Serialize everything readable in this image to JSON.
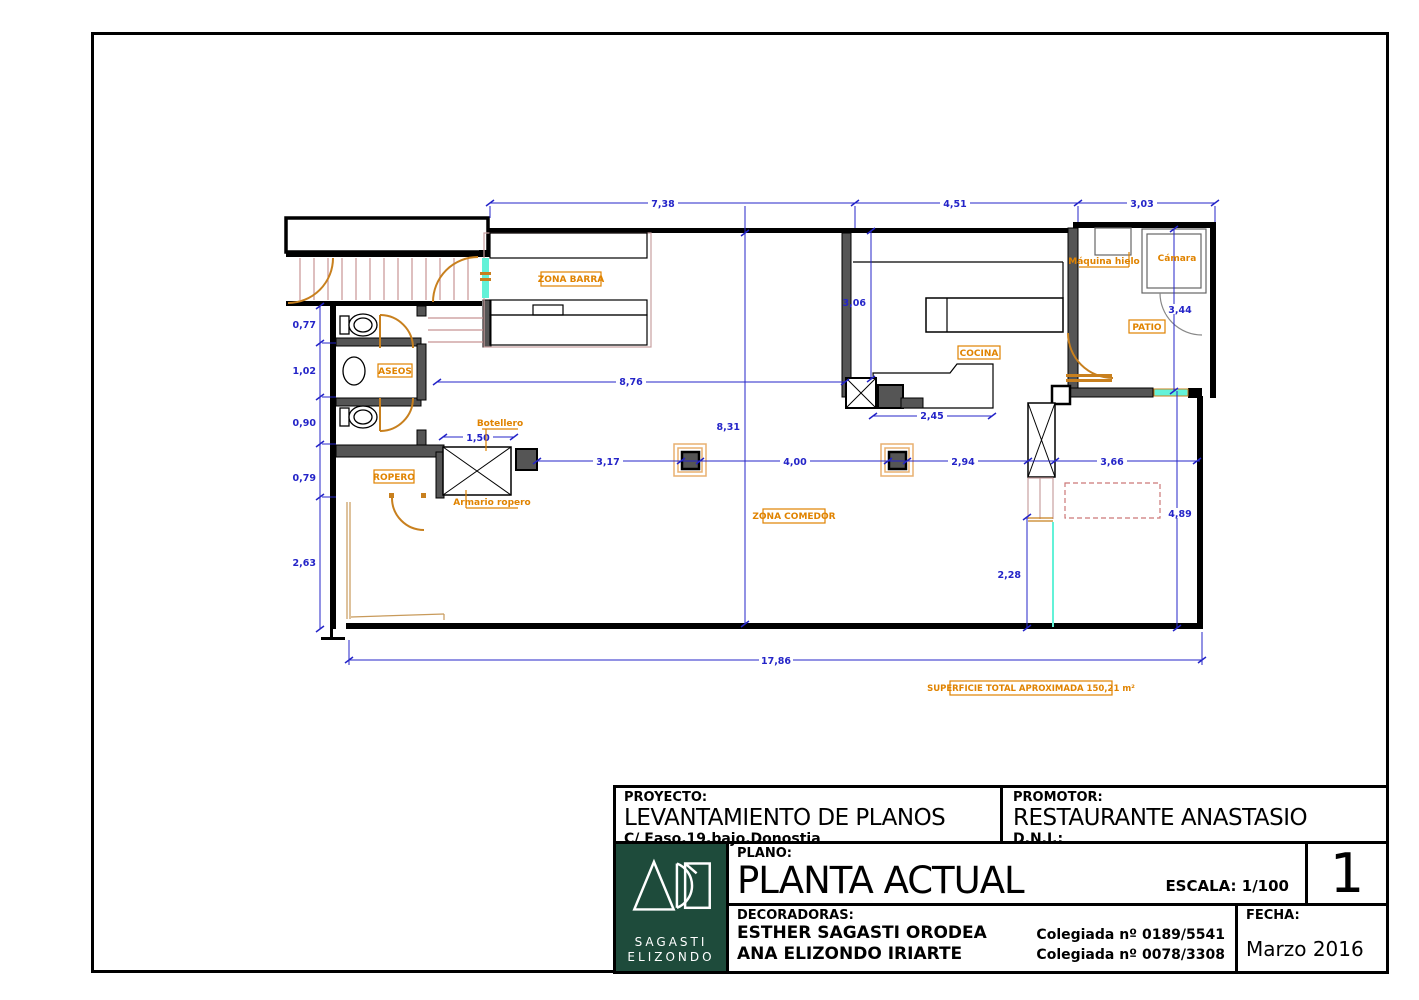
{
  "title_block": {
    "proyecto_label": "PROYECTO:",
    "proyecto_title": "LEVANTAMIENTO DE PLANOS",
    "proyecto_address": "C/ Easo,19,bajo.Donostia",
    "promotor_label": "PROMOTOR:",
    "promotor_name": "RESTAURANTE ANASTASIO",
    "dni_label": "D.N.I.:",
    "plano_label": "PLANO:",
    "plano_title": "PLANTA ACTUAL",
    "escala": "ESCALA: 1/100",
    "sheet_number": "1",
    "decoradoras_label": "DECORADORAS:",
    "decoradora_1": "ESTHER SAGASTI ORODEA",
    "decoradora_2": "ANA ELIZONDO IRIARTE",
    "colegiada_1": "Colegiada  nº 0189/5541",
    "colegiada_2": "Colegiada  nº 0078/3308",
    "fecha_label": "FECHA:",
    "fecha_value": "Marzo 2016",
    "logo_line_1": "SAGASTI",
    "logo_line_2": "ELIZONDO"
  },
  "plan": {
    "rooms": {
      "zona_barra": "ZONA BARRA",
      "aseos": "ASEOS",
      "ropero": "ROPERO",
      "zona_comedor": "ZONA COMEDOR",
      "cocina": "COCINA",
      "patio": "PATIO"
    },
    "annotations": {
      "botellero": "Botellero",
      "armario_ropero": "Armario ropero",
      "maquina_hielo": "Máquina hielo",
      "camara": "Cámara",
      "superficie": "SUPERFICIE TOTAL APROXIMADA 150,21 m²"
    },
    "dims": {
      "top": [
        "7,38",
        "4,51",
        "3,03"
      ],
      "left": [
        "0,77",
        "1,02",
        "0,90",
        "0,79",
        "2,63"
      ],
      "chain": [
        "3,17",
        "4,00",
        "2,94",
        "3,66"
      ],
      "h876": "8,76",
      "v831": "8,31",
      "v306": "3,06",
      "h245": "2,45",
      "v344": "3,44",
      "v489": "4,89",
      "v228": "2,28",
      "h150": "1,50",
      "h1786": "17,86"
    },
    "colors": {
      "dimension_blue": "#2424c8",
      "label_orange": "#e08300",
      "door_orange": "#c8801e",
      "glass_cyan": "#63f2d8",
      "logo_green": "#1e4b3b"
    }
  }
}
